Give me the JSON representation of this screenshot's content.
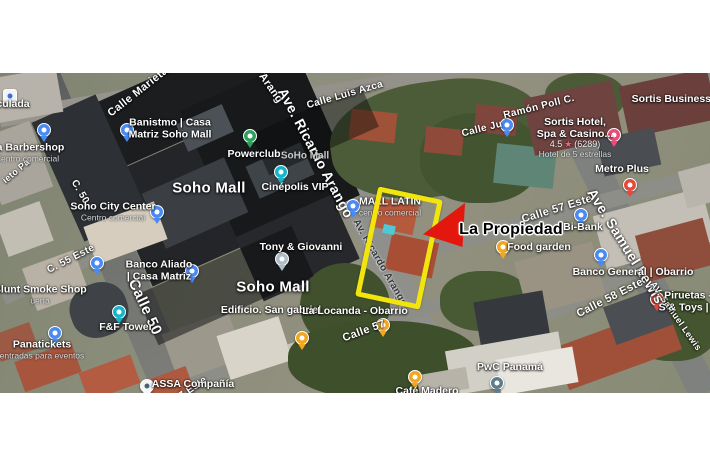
{
  "annotation": {
    "property_label": "La Propiedad",
    "arrow_color": "#e3170e",
    "highlight_color": "#f2e50c"
  },
  "colors": {
    "pin_blue": "#4a8af4",
    "pin_teal": "#16b5c8",
    "pin_green": "#2f9e5f",
    "pin_yellow": "#f2a71f",
    "pin_red": "#e5493d",
    "pin_pink": "#ea4b78",
    "pin_slate": "#5f7c8c",
    "pin_gray": "#aebec7",
    "pin_white": "#f2f5f7"
  },
  "map": {
    "area_labels": [
      {
        "text": "Soho Mall",
        "x": 209,
        "y": 115
      },
      {
        "text": "Soho Mall",
        "x": 273,
        "y": 214
      }
    ],
    "street_labels": [
      {
        "text": "Calle Marieta",
        "x": 138,
        "y": 19,
        "rot": -38,
        "size": 11
      },
      {
        "text": "Calle Luis Azca",
        "x": 345,
        "y": 22,
        "rot": -16,
        "size": 10
      },
      {
        "text": "o Arang",
        "x": 268,
        "y": 11,
        "rot": 55,
        "size": 11
      },
      {
        "text": "Ave. Ricardo Arango",
        "x": 316,
        "y": 80,
        "rot": 62,
        "size": 14
      },
      {
        "text": "Av. Ricardo Arango",
        "x": 380,
        "y": 190,
        "rot": 60,
        "size": 10,
        "dark": true
      },
      {
        "text": "Calle 50",
        "x": 145,
        "y": 234,
        "rot": 65,
        "size": 15
      },
      {
        "text": "C. 50",
        "x": 80,
        "y": 119,
        "rot": 60,
        "size": 10
      },
      {
        "text": "C. 55 Este",
        "x": 71,
        "y": 186,
        "rot": -27,
        "size": 10
      },
      {
        "text": "ieto Pa",
        "x": 16,
        "y": 98,
        "rot": -40,
        "size": 9
      },
      {
        "text": "Calle Ju",
        "x": 482,
        "y": 56,
        "rot": -14,
        "size": 10
      },
      {
        "text": "Ramón Poll C.",
        "x": 539,
        "y": 34,
        "rot": -14,
        "size": 10
      },
      {
        "text": "Calle 57 Este",
        "x": 557,
        "y": 136,
        "rot": -17,
        "size": 11
      },
      {
        "text": "Ave. Samuel Lewis",
        "x": 626,
        "y": 173,
        "rot": 58,
        "size": 14
      },
      {
        "text": "AV. Samuel Lewis",
        "x": 676,
        "y": 243,
        "rot": 55,
        "size": 9
      },
      {
        "text": "Calle 58 Este",
        "x": 610,
        "y": 225,
        "rot": -27,
        "size": 11
      },
      {
        "text": "Calle 57",
        "x": 364,
        "y": 258,
        "rot": -20,
        "size": 11
      },
      {
        "text": "7 Este",
        "x": 193,
        "y": 315,
        "rot": -35,
        "size": 10
      }
    ],
    "pois": [
      {
        "id": "inmaculada",
        "pin": {
          "x": 10,
          "y": 23,
          "color": "#f2f5f7",
          "dot": "#3b6fd4",
          "sq": true
        },
        "label": {
          "x": 13,
          "y": 32,
          "lines": [
            {
              "t": "culada",
              "k": "main"
            }
          ]
        }
      },
      {
        "id": "barbershop",
        "pin": {
          "x": 44,
          "y": 57,
          "color": "#4a8af4"
        },
        "label": {
          "x": 27,
          "y": 80,
          "lines": [
            {
              "t": "ria Barbershop",
              "k": "main"
            },
            {
              "t": "Centro comercial",
              "k": "sub"
            }
          ]
        }
      },
      {
        "id": "banistmo",
        "pin": {
          "x": 127,
          "y": 57,
          "color": "#4a8af4"
        },
        "label": {
          "x": 170,
          "y": 56,
          "lines": [
            {
              "t": "Banistmo | Casa",
              "k": "main"
            },
            {
              "t": "Matriz Soho Mall",
              "k": "main"
            }
          ]
        }
      },
      {
        "id": "soho-city-center",
        "pin": {
          "x": 157,
          "y": 139,
          "color": "#4a8af4"
        },
        "label": {
          "x": 113,
          "y": 139,
          "lines": [
            {
              "t": "Soho City Center",
              "k": "main"
            },
            {
              "t": "Centro comercial",
              "k": "sub"
            }
          ]
        }
      },
      {
        "id": "gas-station",
        "pin": {
          "x": 97,
          "y": 190,
          "color": "#4a8af4"
        }
      },
      {
        "id": "banco-aliado",
        "pin": {
          "x": 192,
          "y": 198,
          "color": "#4a8af4"
        },
        "label": {
          "x": 159,
          "y": 198,
          "lines": [
            {
              "t": "Banco Aliado",
              "k": "main"
            },
            {
              "t": "| Casa Matriz",
              "k": "main"
            }
          ]
        }
      },
      {
        "id": "blunt-smoke-shop",
        "label": {
          "x": 40,
          "y": 222,
          "lines": [
            {
              "t": "Blunt Smoke Shop",
              "k": "main"
            },
            {
              "t": "uería",
              "k": "sub"
            }
          ]
        }
      },
      {
        "id": "ff-tower",
        "pin": {
          "x": 119,
          "y": 239,
          "color": "#16b5c8"
        },
        "label": {
          "x": 126,
          "y": 255,
          "lines": [
            {
              "t": "F&F Tower",
              "k": "main"
            }
          ]
        }
      },
      {
        "id": "panatickets",
        "pin": {
          "x": 55,
          "y": 260,
          "color": "#4a8af4"
        },
        "label": {
          "x": 42,
          "y": 277,
          "lines": [
            {
              "t": "Panatickets",
              "k": "main"
            },
            {
              "t": "entradas para eventos",
              "k": "sub"
            }
          ]
        }
      },
      {
        "id": "assa",
        "pin": {
          "x": 147,
          "y": 313,
          "color": "#f2f5f7",
          "dot": "#47646e"
        },
        "label": {
          "x": 193,
          "y": 312,
          "lines": [
            {
              "t": "ASSA Compañía",
              "k": "main"
            }
          ]
        }
      },
      {
        "id": "powerclub",
        "pin": {
          "x": 250,
          "y": 63,
          "color": "#2f9e5f"
        },
        "label": {
          "x": 254,
          "y": 82,
          "lines": [
            {
              "t": "Powerclub",
              "k": "main"
            }
          ]
        }
      },
      {
        "id": "soho-mall-dim",
        "label": {
          "x": 305,
          "y": 83,
          "lines": [
            {
              "t": "SoHo Mall",
              "k": "dim"
            }
          ]
        }
      },
      {
        "id": "cinepolis",
        "pin": {
          "x": 281,
          "y": 99,
          "color": "#16b5c8"
        },
        "label": {
          "x": 295,
          "y": 115,
          "lines": [
            {
              "t": "Cinépolis VIP",
              "k": "main"
            }
          ]
        }
      },
      {
        "id": "mall-latin",
        "pin": {
          "x": 353,
          "y": 133,
          "color": "#4a8af4"
        },
        "label": {
          "x": 390,
          "y": 134,
          "lines": [
            {
              "t": "MALL LATIN",
              "k": "main"
            },
            {
              "t": "centro comercial",
              "k": "sub"
            }
          ]
        }
      },
      {
        "id": "tony-giovanni",
        "pin": {
          "x": 282,
          "y": 186,
          "color": "#aebec7"
        },
        "label": {
          "x": 301,
          "y": 175,
          "lines": [
            {
              "t": "Tony & Giovanni",
              "k": "main"
            }
          ]
        }
      },
      {
        "id": "food-garden",
        "pin": {
          "x": 503,
          "y": 174,
          "color": "#f2a71f"
        },
        "label": {
          "x": 539,
          "y": 175,
          "lines": [
            {
              "t": "Food garden",
              "k": "main"
            }
          ]
        }
      },
      {
        "id": "bi-bank",
        "pin": {
          "x": 581,
          "y": 142,
          "color": "#4a8af4"
        },
        "label": {
          "x": 583,
          "y": 155,
          "lines": [
            {
              "t": "Bi-Bank",
              "k": "main"
            }
          ]
        }
      },
      {
        "id": "banco-general",
        "pin": {
          "x": 601,
          "y": 182,
          "color": "#4a8af4"
        },
        "label": {
          "x": 633,
          "y": 200,
          "lines": [
            {
              "t": "Banco General | Obarrio",
              "k": "main"
            }
          ]
        }
      },
      {
        "id": "metro-plus",
        "pin": {
          "x": 630,
          "y": 112,
          "color": "#e5493d"
        },
        "label": {
          "x": 622,
          "y": 97,
          "lines": [
            {
              "t": "Metro Plus",
              "k": "main"
            }
          ]
        }
      },
      {
        "id": "sortis-hotel",
        "pin": {
          "x": 614,
          "y": 62,
          "color": "#ea4b78"
        },
        "label": {
          "x": 575,
          "y": 65,
          "lines": [
            {
              "t": "Sortis Hotel,",
              "k": "main"
            },
            {
              "t": "Spa & Casino...",
              "k": "main"
            },
            {
              "k": "rating",
              "value": "4.5",
              "star": "★",
              "count": "(6289)"
            },
            {
              "t": "Hotel de 5 estrellas",
              "k": "sub"
            }
          ]
        }
      },
      {
        "id": "sortis-business",
        "label": {
          "x": 676,
          "y": 27,
          "lines": [
            {
              "t": "Sortis Business T",
              "k": "main"
            }
          ]
        }
      },
      {
        "id": "piruetas",
        "pin": {
          "x": 657,
          "y": 226,
          "color": "#e5493d"
        },
        "label": {
          "x": 688,
          "y": 229,
          "lines": [
            {
              "t": "Piruetas -",
              "k": "main"
            },
            {
              "t": "S & Toys | 8",
              "k": "main"
            }
          ]
        }
      },
      {
        "id": "pwc-panama",
        "pin": {
          "x": 497,
          "y": 310,
          "color": "#5f7c8c"
        },
        "label": {
          "x": 510,
          "y": 295,
          "lines": [
            {
              "t": "PwC Panamá",
              "k": "main"
            }
          ]
        }
      },
      {
        "id": "cafe-madero",
        "pin": {
          "x": 415,
          "y": 304,
          "color": "#f2a71f"
        },
        "label": {
          "x": 427,
          "y": 319,
          "lines": [
            {
              "t": "Café Madero",
              "k": "main"
            }
          ]
        }
      },
      {
        "id": "poll-street-pin",
        "pin": {
          "x": 507,
          "y": 52,
          "color": "#4a8af4"
        }
      },
      {
        "id": "food-pin-locanda",
        "pin": {
          "x": 302,
          "y": 265,
          "color": "#f2a71f"
        }
      },
      {
        "id": "food-pin-calle57",
        "pin": {
          "x": 383,
          "y": 252,
          "color": "#f2a71f"
        }
      },
      {
        "id": "edificio-san-gabriel",
        "label": {
          "x": 271,
          "y": 238,
          "lines": [
            {
              "t": "Edificio. San gabriel",
              "k": "main"
            }
          ]
        }
      },
      {
        "id": "la-locanda",
        "label": {
          "x": 355,
          "y": 239,
          "lines": [
            {
              "t": "La Locanda - Obarrio",
              "k": "main"
            }
          ]
        }
      }
    ]
  }
}
